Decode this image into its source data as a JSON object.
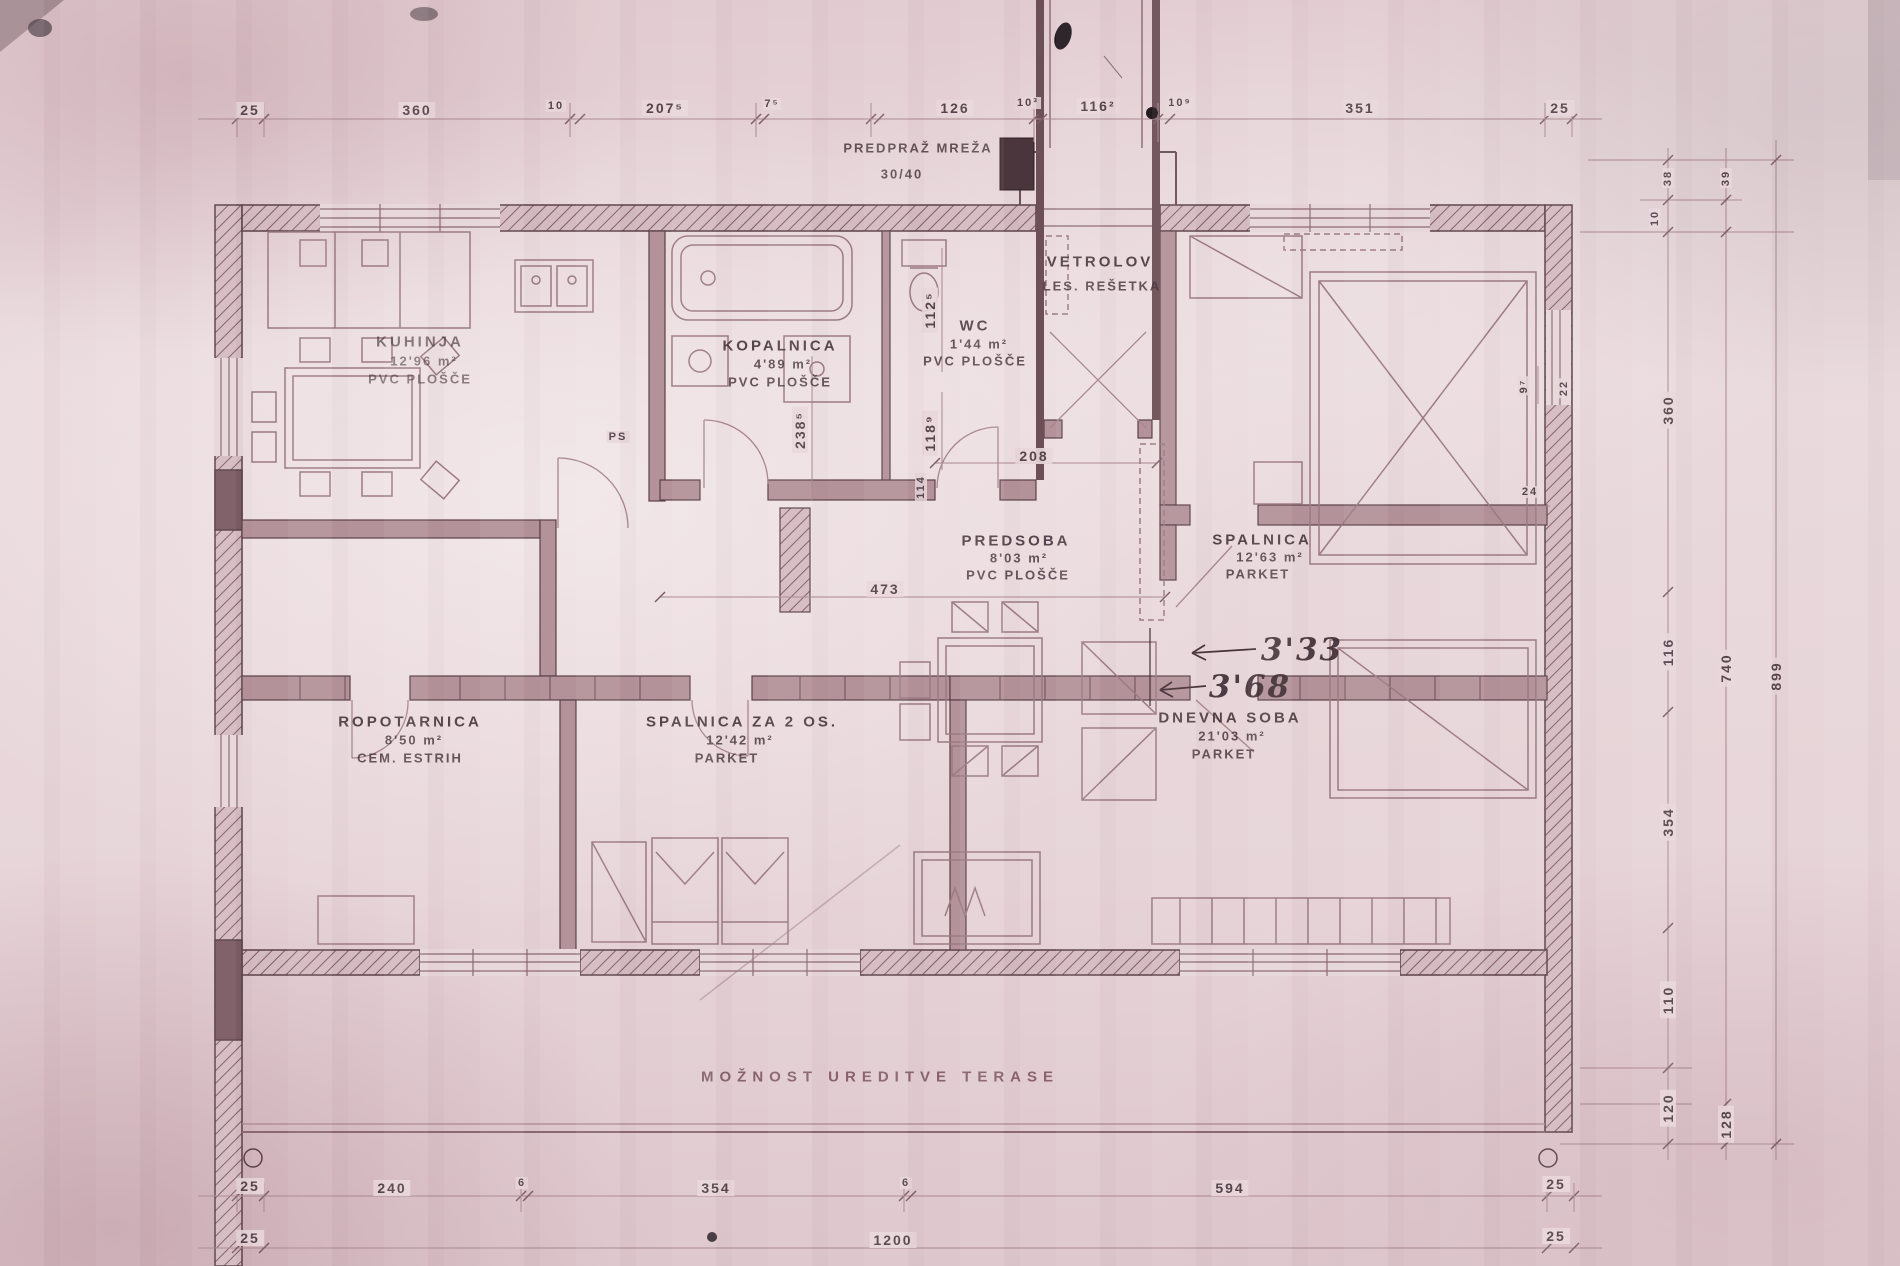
{
  "dims": {
    "top": [
      "25",
      "360",
      "10",
      "207⁵",
      "7⁵",
      "126",
      "10³",
      "116²",
      "10⁹",
      "351",
      "25"
    ],
    "bottom_row1": [
      "25",
      "240",
      "6",
      "354",
      "6",
      "594",
      "25"
    ],
    "bottom_row2": [
      "25",
      "1200",
      "25"
    ],
    "right_col1": [
      "38",
      "10",
      "360",
      "116",
      "354",
      "110",
      "120"
    ],
    "right_col2": [
      "39",
      "740",
      "128"
    ],
    "right_col3": [
      "899"
    ],
    "interior": {
      "w208": "208",
      "w473": "473",
      "h238": "238⁵",
      "h118": "118⁹",
      "h112": "112⁵",
      "h114": "114",
      "h97": "9⁷",
      "w22": "22",
      "w24": "24"
    }
  },
  "entrance": {
    "label": "PREDPRAŽ MREŽA",
    "size": "30/40"
  },
  "rooms": {
    "kuhinja": {
      "name": "KUHINJA",
      "area": "12'96 m²",
      "floor": "PVC PLOŠČE"
    },
    "kopalnica": {
      "name": "KOPALNICA",
      "area": "4'89 m²",
      "floor": "PVC PLOŠČE"
    },
    "wc": {
      "name": "WC",
      "area": "1'44 m²",
      "floor": "PVC PLOŠČE"
    },
    "vetrolov": {
      "name": "VETROLOV",
      "sub": "LES. REŠETKA"
    },
    "spalnica": {
      "name": "SPALNICA",
      "area": "12'63 m²",
      "floor": "PARKET"
    },
    "predsoba": {
      "name": "PREDSOBA",
      "area": "8'03 m²",
      "floor": "PVC PLOŠČE"
    },
    "ropotarnica": {
      "name": "ROPOTARNICA",
      "area": "8'50 m²",
      "floor": "CEM. ESTRIH"
    },
    "spalnica2": {
      "name": "SPALNICA ZA 2 OS.",
      "area": "12'42 m²",
      "floor": "PARKET"
    },
    "dnevna": {
      "name": "DNEVNA SOBA",
      "area": "21'03 m²",
      "floor": "PARKET"
    }
  },
  "notes": {
    "terrace": "MOŽNOST UREDITVE TERASE",
    "ps": "PS",
    "hand1": "3'33",
    "hand2": "3'68"
  }
}
